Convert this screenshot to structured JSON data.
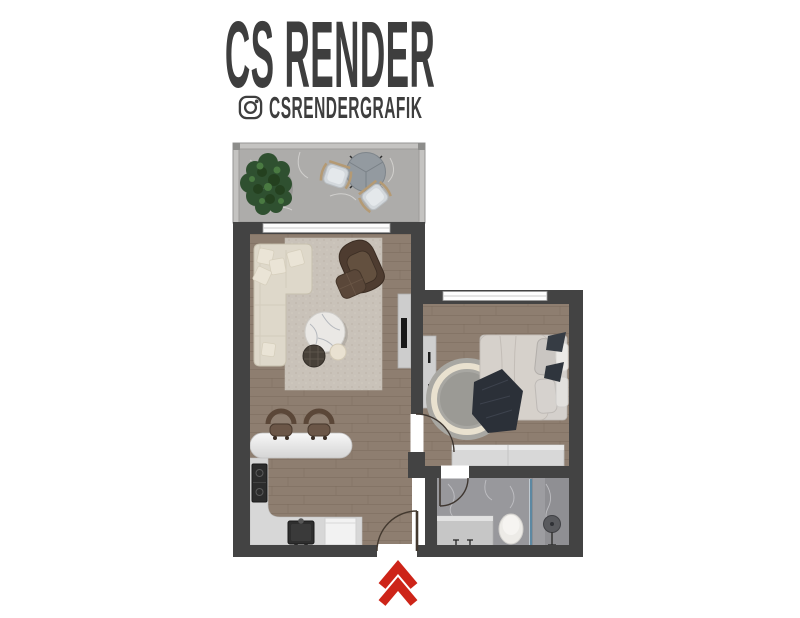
{
  "header": {
    "title": "CS RENDER",
    "instagram_handle": "CSRENDERGRAFIK",
    "instagram_icon": "instagram-camera-glyph"
  },
  "entrance": {
    "marker": "double-chevron-up",
    "color": "#cd2418"
  },
  "floorplan": {
    "rooms": [
      "balcony",
      "living-room",
      "kitchen",
      "bedroom",
      "bathroom",
      "hall"
    ],
    "doors": [
      "entrance-door",
      "bedroom-door",
      "bathroom-door"
    ],
    "windows": [
      "living-room-balcony-window",
      "bedroom-window"
    ]
  },
  "palette": {
    "background": "#ffffff",
    "title_color": "#3e3e3e",
    "wall": "#434343",
    "wood_floor": "#8e7e70",
    "balcony_floor": "#adacaa",
    "bathroom_floor": "#98989c",
    "living_rug": "#c9c2b9",
    "kitchen_counter": "#d7d7d7",
    "sofa": "#ded8ca",
    "armchair": "#4e3c30",
    "bed_linen": "#d5d0ca",
    "blanket": "#2b3038",
    "glass_partition": "#5c88a2",
    "accent_red": "#cd2418"
  }
}
